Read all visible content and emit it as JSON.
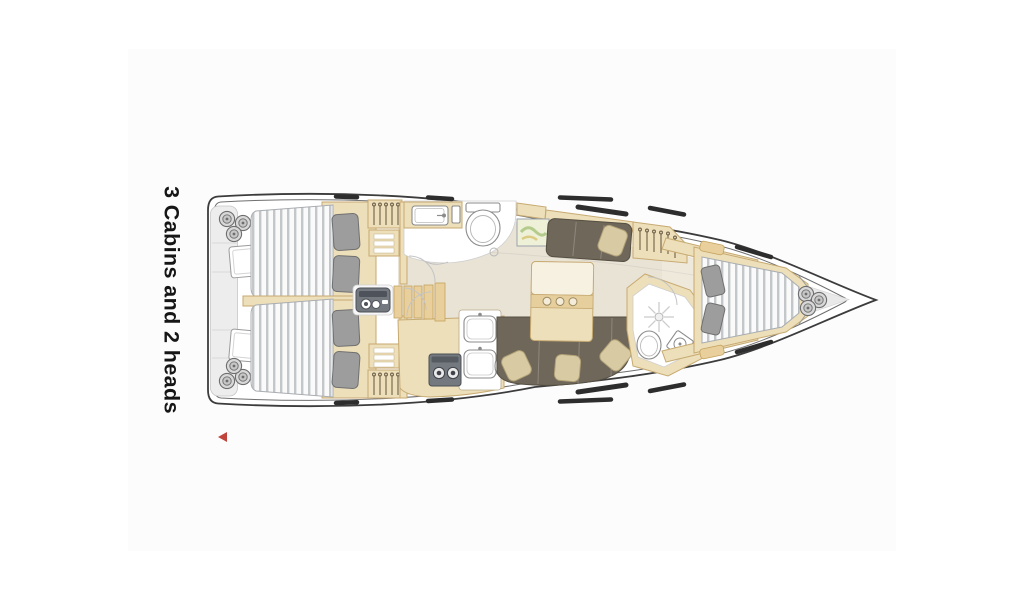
{
  "page": {
    "background": "#ffffff",
    "panel_color": "#fcfcfc"
  },
  "floorplan": {
    "label": "3 Cabins and 2 heads",
    "view": "top-down sailboat interior layout, bow pointing right",
    "features": [
      "stern-platform-with-fender-coils",
      "aft-cabin-port-double-bed",
      "aft-cabin-starboard-double-bed",
      "wardrobes-with-hangers",
      "forward-head-sink-toilet",
      "galley-stove-and-sinks",
      "companionway-steps",
      "engine-panel",
      "chart-map",
      "port-settee",
      "salon-table",
      "starboard-l-sofa",
      "aft-head-with-shower-toilet-sink",
      "hanging-locker",
      "forward-v-berth-cabin",
      "bow-locker-rope-coils"
    ]
  },
  "controls": {
    "prev_arrow": {
      "shape": "left-triangle",
      "color": "#c0443c"
    }
  },
  "colors": {
    "background": "#ffffff",
    "panel": "#fcfcfc",
    "hull_stroke": "#3c3c3c",
    "inner_stroke": "#6f6f6f",
    "wood": "#eddfb9",
    "wood_stroke": "#c7aa72",
    "wood2": "#e9cf9c",
    "wood2_stroke": "#c3a25e",
    "sole": "#e9e3d6",
    "uph": "#6f6759",
    "uph_stroke": "#554f42",
    "pillow_beige": "#d8cba4",
    "pillow_beige_stroke": "#b1a177",
    "pillow_gray": "#9d9d9d",
    "pillow_gray_stroke": "#707070",
    "fixture_stroke": "#8b8b8b",
    "gray_item": "#74787f",
    "hatch_dark": "#2d2d2d",
    "accent_red": "#c0443c",
    "platform": "#ededed"
  }
}
